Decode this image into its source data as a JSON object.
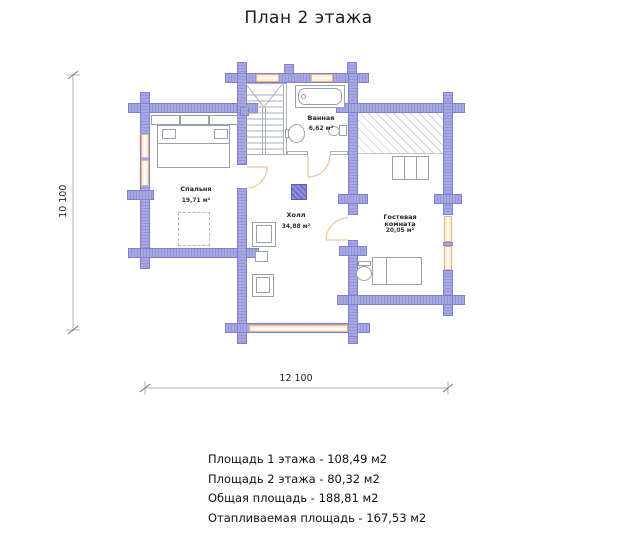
{
  "title": "План 2 этажа",
  "plan": {
    "rooms": [
      {
        "name": "Спальня",
        "area": "19,71 м²"
      },
      {
        "name": "Ванная",
        "area": "6,62 м²"
      },
      {
        "name": "Холл",
        "area": "34,88 м²"
      },
      {
        "name": "Гостевая комната",
        "area": "20,05 м²"
      }
    ],
    "dimensions": {
      "height_mm": "10 100",
      "width_mm": "12 100"
    }
  },
  "summary": {
    "lines": [
      "Площадь 1 этажа - 108,49 м2",
      "Площадь 2 этажа - 80,32 м2",
      "Общая площадь - 188,81 м2",
      "Отапливаемая площадь - 167,53 м2"
    ]
  },
  "theme": {
    "bg": "#ffffff",
    "wall_fill": "#a7a7e3",
    "wall_stripe": "#9595d6",
    "wall_border": "#7f7fcb",
    "window_fill": "#fdeeda",
    "window_border": "#f0b37e",
    "door_color": "#f5c79b",
    "line_color": "#9aa0ac",
    "hatch_color": "#d0d3da",
    "chimney_fill": "#8d8dda",
    "chimney_dark": "#5d5db8",
    "dim_color": "#b5b5b5",
    "text_dark": "#1c1c1c"
  }
}
